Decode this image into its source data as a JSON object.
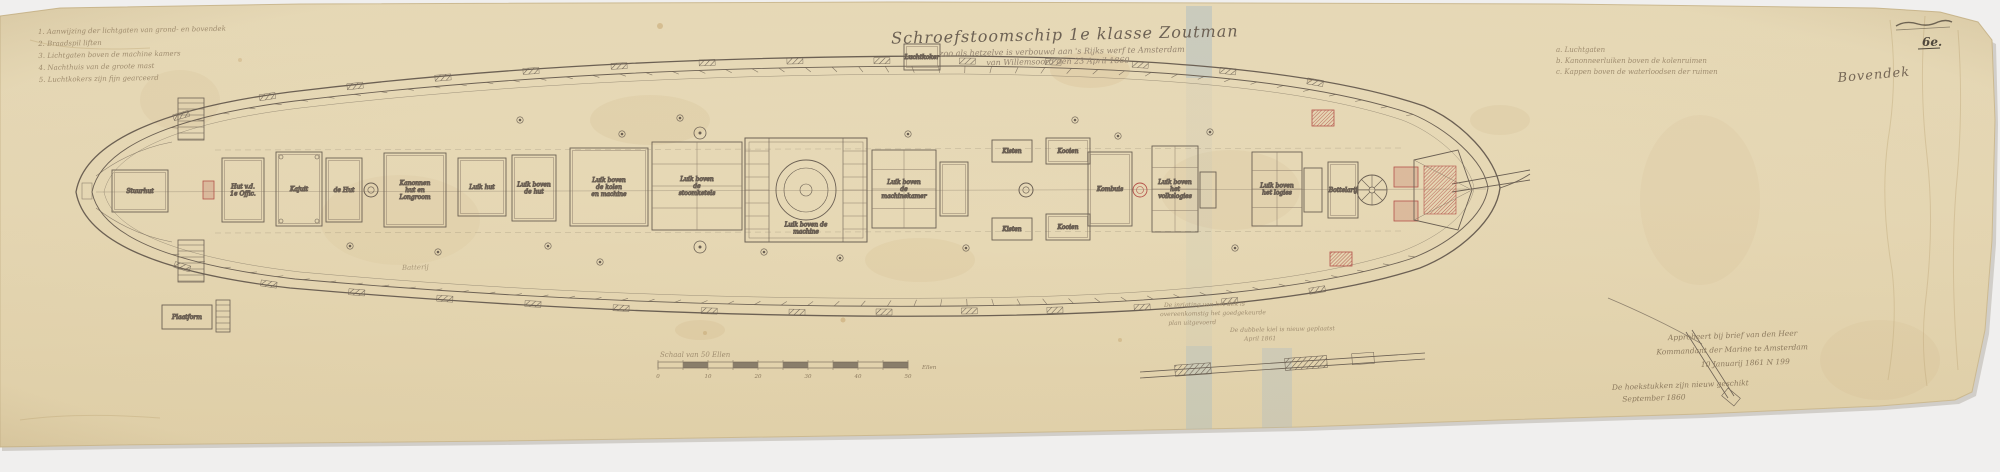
{
  "colors": {
    "paper": "#e7d9b6",
    "paper_edge": "#d6c49c",
    "ink": "#6b6054",
    "ink_light": "#8d7f6c",
    "red_accent": "#b5524a",
    "tape_blue": "#a9bcc9",
    "background": "#f0efee"
  },
  "document": {
    "title": "Schroefstoomschip 1e klasse Zoutman",
    "subtitle_line1": "zoo als hetzelve is verbouwd aan 's Rijks werf te Amsterdam",
    "subtitle_line2": "van Willemsoord den 23 April 1860",
    "sheet_label": "Bovendek",
    "archive_mark": "6e.",
    "deck_inscription": "Batterij"
  },
  "notes_top_left": {
    "items": [
      "1. Aanwijzing der lichtgaten van grond- en bovendek",
      "2. Braadspil liften",
      "3. Lichtgaten boven de machine kamers",
      "4. Nachthuis van de groote mast",
      "5. Luchtkokers zijn fijn gearceerd"
    ]
  },
  "notes_top_right": {
    "items": [
      "a. Luchtgaten",
      "b. Kanonneerluiken boven de kolenruimen",
      "c. Kappen boven de waterloodsen der ruimen"
    ]
  },
  "approval_note": {
    "lines": [
      "Approbeert bij brief van den Heer",
      "Kommandant der Marine te Amsterdam",
      "10 Januarij 1861 N 199"
    ]
  },
  "secondary_note": {
    "lines": [
      "De hoekstukken zijn nieuw geschikt",
      "September 1860"
    ]
  },
  "center_note_1": {
    "lines": [
      "De inrigting van het dek is",
      "overeenkomstig het goedgekeurde",
      "plan uitgevoerd"
    ]
  },
  "center_note_2": {
    "lines": [
      "De dubbele kiel is nieuw geplaatst",
      "April 1861"
    ]
  },
  "inventory_sticker": {
    "prefix": "IV",
    "code": "K I 148",
    "sub": "a"
  },
  "scale_bar": {
    "label": "Schaal van 50 Ellen",
    "tick_labels": [
      "0",
      "10",
      "20",
      "30",
      "40",
      "50"
    ],
    "unit": "Ellen"
  },
  "deck_structures": [
    {
      "t": "room",
      "x": 112,
      "y": 170,
      "w": 56,
      "h": 42,
      "label": "Stuurhut"
    },
    {
      "t": "stairs",
      "x": 178,
      "y": 98,
      "w": 26,
      "h": 42
    },
    {
      "t": "stairs",
      "x": 178,
      "y": 240,
      "w": 26,
      "h": 42
    },
    {
      "t": "redbox",
      "x": 203,
      "y": 181,
      "w": 11,
      "h": 18
    },
    {
      "t": "room",
      "x": 222,
      "y": 158,
      "w": 42,
      "h": 64,
      "label": "Hut v.d. 1e Offic."
    },
    {
      "t": "room",
      "x": 276,
      "y": 152,
      "w": 46,
      "h": 74,
      "label": "Kajuit",
      "pins": true
    },
    {
      "t": "room",
      "x": 326,
      "y": 158,
      "w": 36,
      "h": 64,
      "label": "de Hut"
    },
    {
      "t": "mast",
      "x": 371,
      "y": 190,
      "r": 7
    },
    {
      "t": "room",
      "x": 384,
      "y": 153,
      "w": 62,
      "h": 74,
      "label": "Kanonnen hut en Longroom"
    },
    {
      "t": "room",
      "x": 458,
      "y": 158,
      "w": 48,
      "h": 58,
      "label": "Luik hut"
    },
    {
      "t": "room",
      "x": 512,
      "y": 155,
      "w": 44,
      "h": 66,
      "label": "Luik boven de hut"
    },
    {
      "t": "room",
      "x": 570,
      "y": 148,
      "w": 78,
      "h": 78,
      "label": "Luik boven de kolen en machine"
    },
    {
      "t": "gridroom",
      "x": 652,
      "y": 142,
      "w": 90,
      "h": 88,
      "label": "Luik boven de stoomketels"
    },
    {
      "t": "vent",
      "x": 700,
      "y": 133,
      "r": 6
    },
    {
      "t": "vent",
      "x": 700,
      "y": 247,
      "r": 6
    },
    {
      "t": "engine",
      "x": 745,
      "y": 138,
      "w": 122,
      "h": 104,
      "label": "Luik boven de machine"
    },
    {
      "t": "gridroom",
      "x": 872,
      "y": 150,
      "w": 64,
      "h": 78,
      "label": "Luik boven de machinekamer"
    },
    {
      "t": "room",
      "x": 940,
      "y": 162,
      "w": 28,
      "h": 54
    },
    {
      "t": "room",
      "x": 904,
      "y": 44,
      "w": 36,
      "h": 26,
      "label": "Luchtkoker"
    },
    {
      "t": "room",
      "x": 992,
      "y": 140,
      "w": 40,
      "h": 22,
      "label": "Kisten"
    },
    {
      "t": "room",
      "x": 992,
      "y": 218,
      "w": 40,
      "h": 22,
      "label": "Kisten"
    },
    {
      "t": "mast",
      "x": 1026,
      "y": 190,
      "r": 7
    },
    {
      "t": "room",
      "x": 1046,
      "y": 138,
      "w": 44,
      "h": 26,
      "label": "Kooien"
    },
    {
      "t": "room",
      "x": 1046,
      "y": 214,
      "w": 44,
      "h": 26,
      "label": "Kooien"
    },
    {
      "t": "room",
      "x": 1088,
      "y": 152,
      "w": 44,
      "h": 74,
      "label": "Kombuis"
    },
    {
      "t": "redvent",
      "x": 1140,
      "y": 190,
      "r": 7
    },
    {
      "t": "gridroom",
      "x": 1152,
      "y": 146,
      "w": 46,
      "h": 86,
      "label": "Luik boven het volkslogies"
    },
    {
      "t": "room",
      "x": 1200,
      "y": 172,
      "w": 16,
      "h": 36
    },
    {
      "t": "gridroom",
      "x": 1252,
      "y": 152,
      "w": 50,
      "h": 74,
      "label": "Luik boven het logies"
    },
    {
      "t": "room",
      "x": 1304,
      "y": 168,
      "w": 18,
      "h": 44
    },
    {
      "t": "room",
      "x": 1328,
      "y": 162,
      "w": 30,
      "h": 56,
      "label": "Bottelarij"
    },
    {
      "t": "capstan",
      "x": 1372,
      "y": 190,
      "r": 15
    },
    {
      "t": "redbox",
      "x": 1394,
      "y": 167,
      "w": 24,
      "h": 20
    },
    {
      "t": "redbox",
      "x": 1394,
      "y": 201,
      "w": 24,
      "h": 20
    },
    {
      "t": "redgrate",
      "x": 1312,
      "y": 110,
      "w": 22,
      "h": 16
    },
    {
      "t": "redgrate",
      "x": 1330,
      "y": 252,
      "w": 22,
      "h": 14
    },
    {
      "t": "bow",
      "x": 1414,
      "y": 150,
      "w": 58,
      "h": 80
    },
    {
      "t": "room",
      "x": 162,
      "y": 305,
      "w": 50,
      "h": 24,
      "label": "Plaatform"
    },
    {
      "t": "stairs",
      "x": 216,
      "y": 300,
      "w": 14,
      "h": 32
    }
  ],
  "small_vents": [
    [
      438,
      252
    ],
    [
      548,
      246
    ],
    [
      622,
      134
    ],
    [
      764,
      252
    ],
    [
      908,
      134
    ],
    [
      966,
      248
    ],
    [
      1118,
      136
    ],
    [
      680,
      118
    ],
    [
      840,
      258
    ],
    [
      1210,
      132
    ],
    [
      1235,
      248
    ],
    [
      520,
      120
    ],
    [
      350,
      246
    ],
    [
      600,
      262
    ],
    [
      1075,
      120
    ]
  ]
}
